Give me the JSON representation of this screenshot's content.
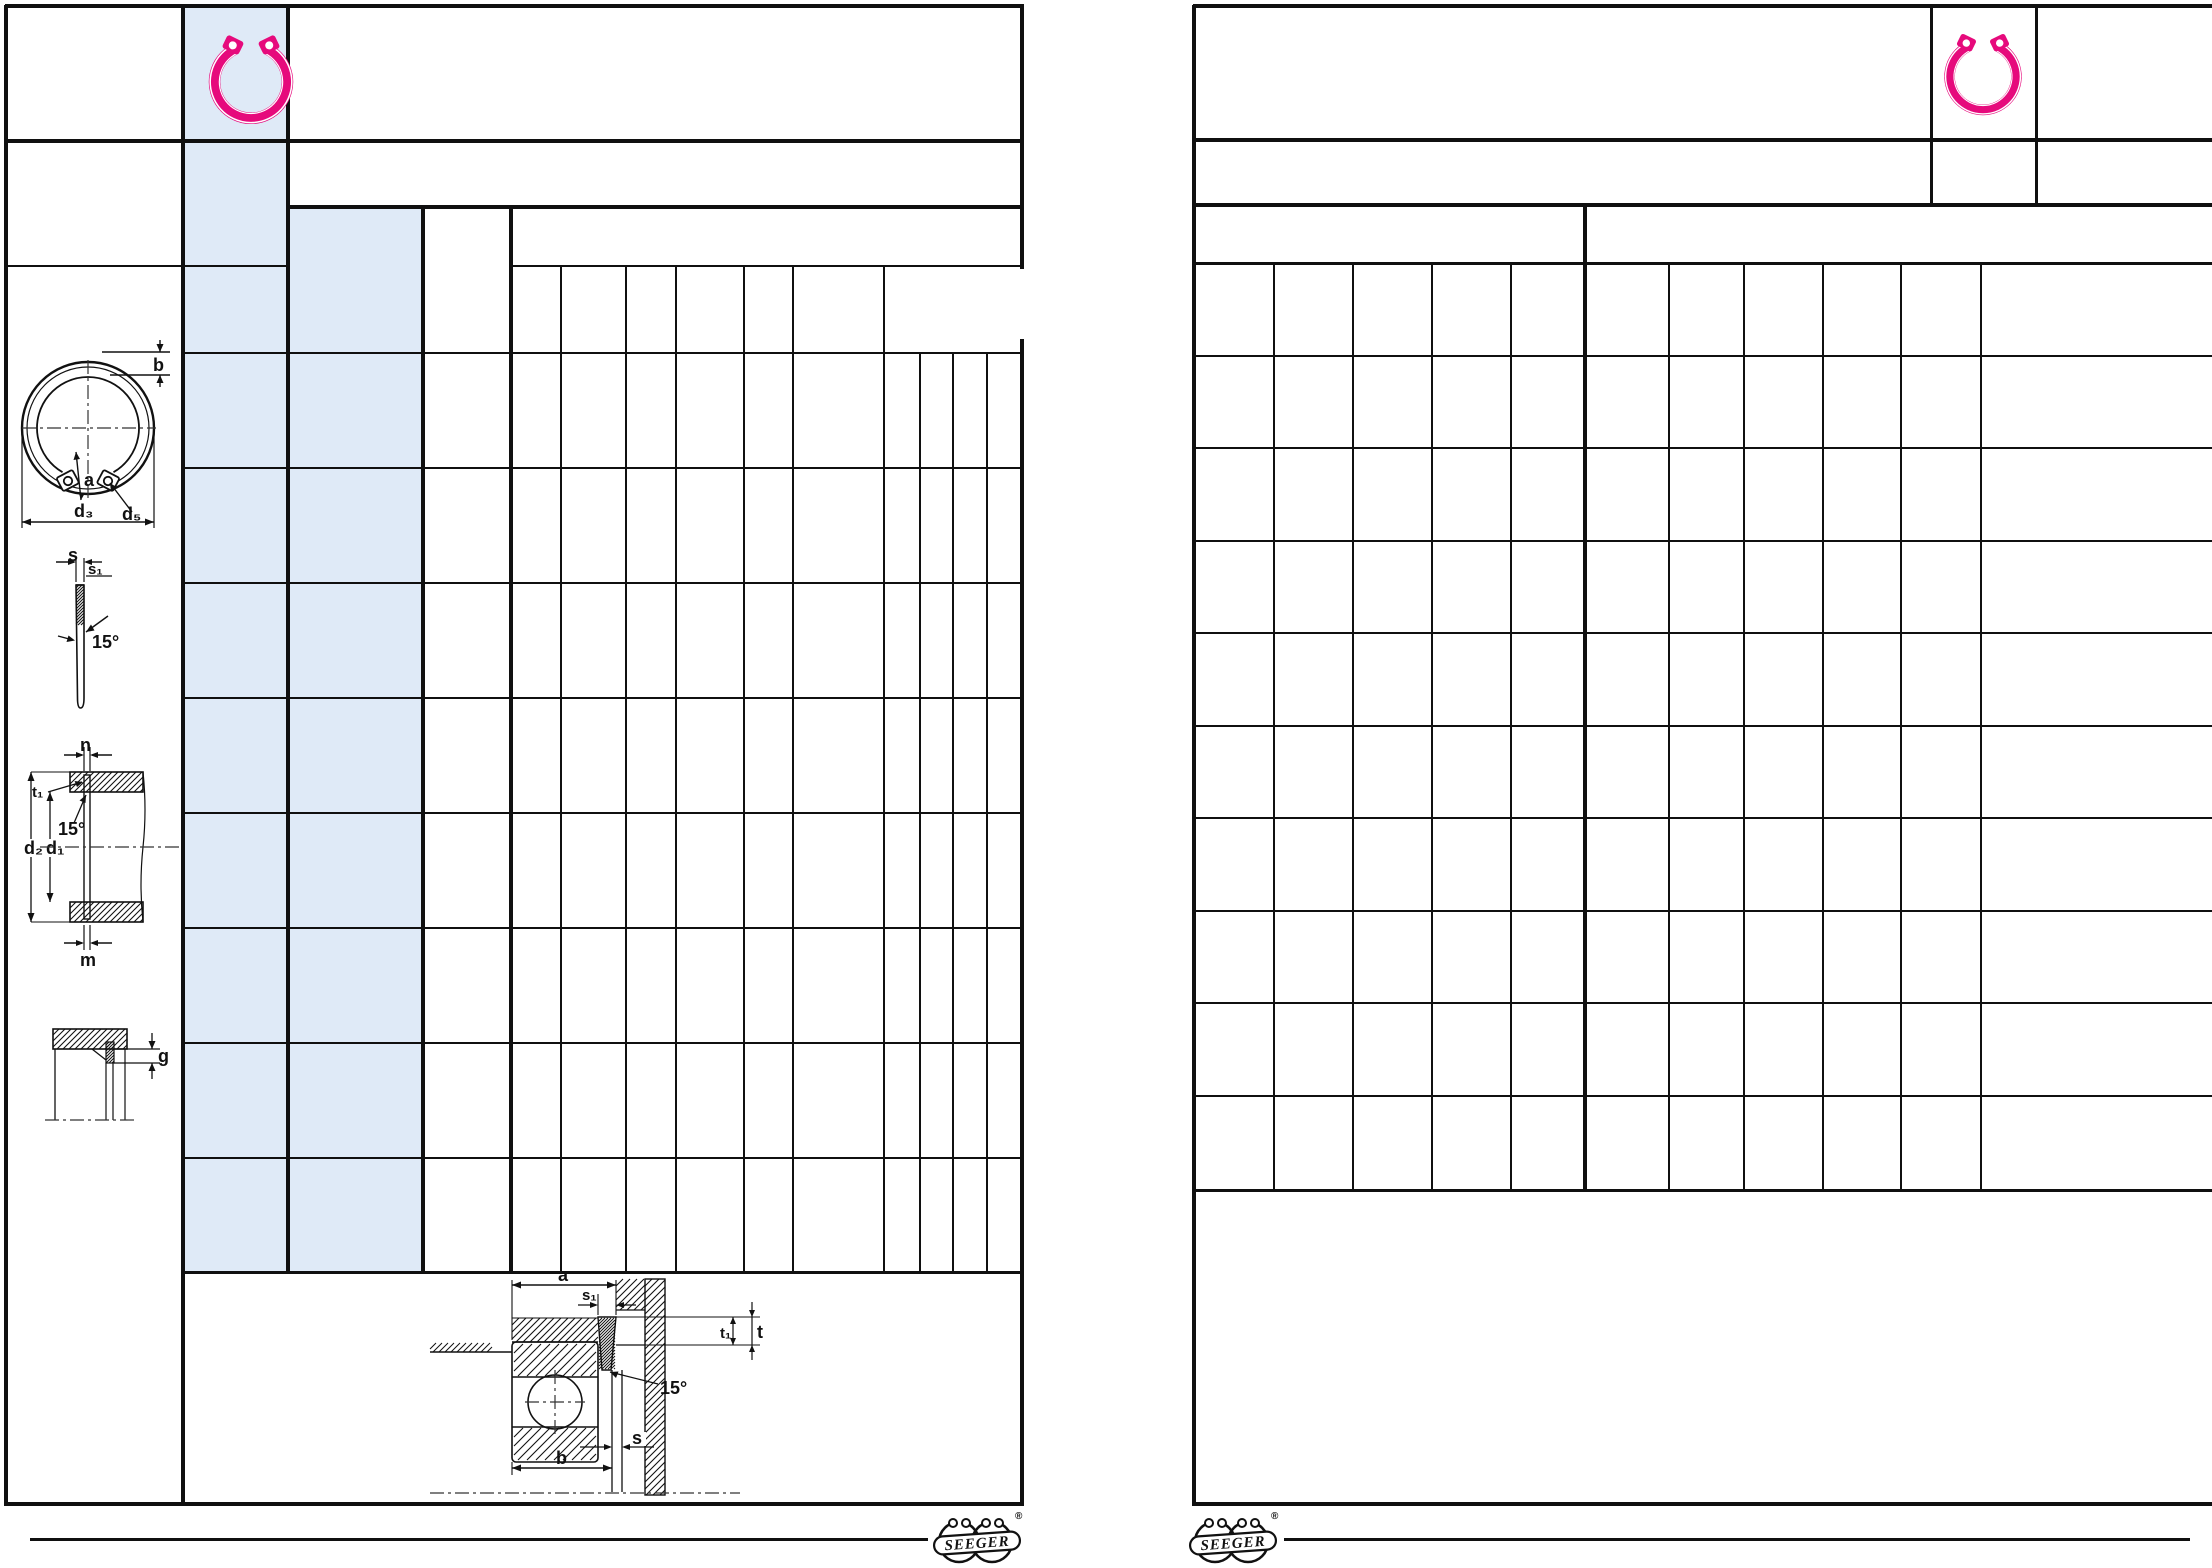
{
  "colors": {
    "accent_pink": "#e60a7c",
    "highlight_blue": "#dfeaf7",
    "line_black": "#101010"
  },
  "left_sheet": {
    "icon": "internal-retaining-ring",
    "drawings": {
      "ring_front_view": {
        "b": "b",
        "a": "a",
        "d5": "d₅",
        "d3": "d₃"
      },
      "ring_profile_view": {
        "s": "s",
        "s1": "s₁",
        "angle": "15°"
      },
      "housing_bore_section": {
        "n": "n",
        "t1": "t₁",
        "angle": "15°",
        "d2": "d₂",
        "d1": "d₁",
        "m": "m"
      },
      "edge_clearance_detail": {
        "g": "g"
      },
      "bearing_mount_section": {
        "a": "a",
        "s1": "s₁",
        "t1": "t₁",
        "t": "t",
        "angle": "15°",
        "s": "s",
        "b": "b"
      }
    }
  },
  "right_sheet": {
    "icon": "internal-retaining-ring"
  },
  "footer": {
    "brand": "SEEGER",
    "registered_mark": "®"
  }
}
